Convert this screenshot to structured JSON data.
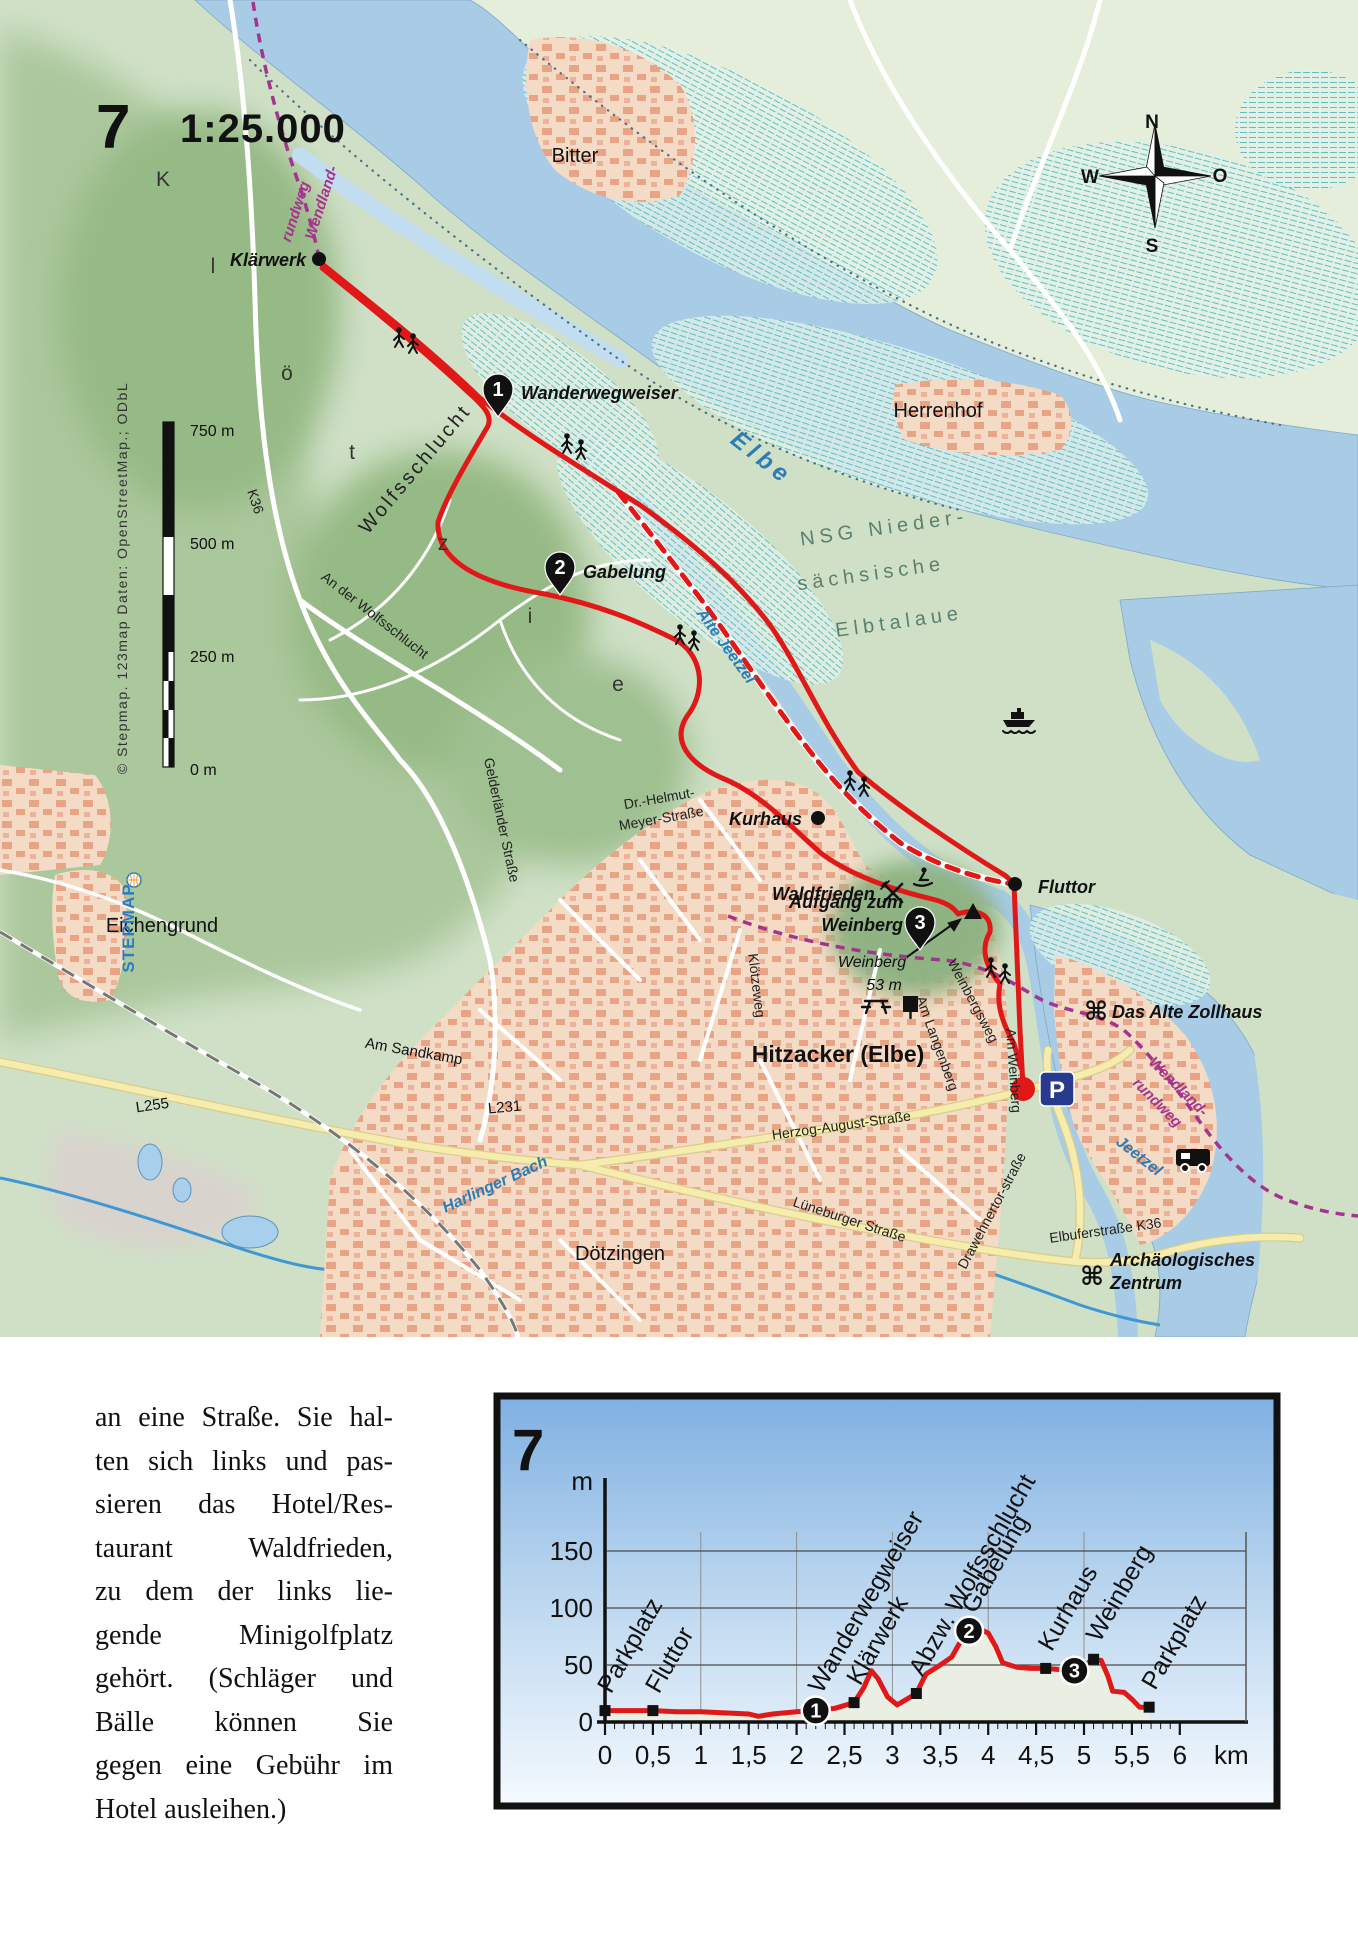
{
  "map": {
    "number": "7",
    "scale": "1:25.000",
    "colors": {
      "base_green": "#cfe0c6",
      "pale_marsh": "#e4eeda",
      "forest": "#9cbd8c",
      "water": "#a8cbe6",
      "water_light": "#c2dcf0",
      "urban": "#f4dbc6",
      "building": "#e9a486",
      "route_red": "#e01818",
      "wendland_purple": "#a5348e",
      "road_yellow": "#f5ecae",
      "rail_gray": "#777777",
      "hatch_teal": "#5fc0bd",
      "parking_blue": "#283a8e"
    },
    "labels": [
      {
        "n": "map-number",
        "t": "7",
        "x": 96,
        "y": 148,
        "c": "t7",
        "a": "start"
      },
      {
        "n": "map-scale-ratio",
        "t": "1:25.000",
        "x": 180,
        "y": 142,
        "c": "tscale",
        "a": "start"
      },
      {
        "n": "label-klaerwerk",
        "t": "Klärwerk",
        "x": 306,
        "y": 266,
        "c": "poi",
        "a": "end"
      },
      {
        "n": "label-bitter",
        "t": "Bitter",
        "x": 575,
        "y": 162,
        "c": "plc"
      },
      {
        "n": "label-herrenhof",
        "t": "Herrenhof",
        "x": 938,
        "y": 417,
        "c": "plc"
      },
      {
        "n": "label-wanderwegweiser",
        "t": "Wanderwegweiser",
        "x": 521,
        "y": 399,
        "c": "poi",
        "a": "start"
      },
      {
        "n": "label-gabelung",
        "t": "Gabelung",
        "x": 583,
        "y": 578,
        "c": "poi",
        "a": "start"
      },
      {
        "n": "label-wolfsschlucht",
        "t": "Wolfsschlucht",
        "x": 420,
        "y": 473,
        "r": -50,
        "c": "area"
      },
      {
        "n": "label-kloetzie-k",
        "t": "K",
        "x": 163,
        "y": 186,
        "c": "arealet"
      },
      {
        "n": "label-kloetzie-l",
        "t": "l",
        "x": 213,
        "y": 273,
        "c": "arealet"
      },
      {
        "n": "label-kloetzie-oe",
        "t": "ö",
        "x": 287,
        "y": 380,
        "c": "arealet"
      },
      {
        "n": "label-kloetzie-t",
        "t": "t",
        "x": 352,
        "y": 459,
        "c": "arealet"
      },
      {
        "n": "label-kloetzie-z",
        "t": "z",
        "x": 443,
        "y": 550,
        "c": "arealet"
      },
      {
        "n": "label-kloetzie-i",
        "t": "i",
        "x": 530,
        "y": 623,
        "c": "arealet"
      },
      {
        "n": "label-kloetzie-e",
        "t": "e",
        "x": 618,
        "y": 691,
        "c": "arealet"
      },
      {
        "n": "label-elbe",
        "t": "Elbe",
        "x": 757,
        "y": 464,
        "r": 38,
        "c": "water-lg"
      },
      {
        "n": "label-nsg-1",
        "t": "NSG Nieder-",
        "x": 885,
        "y": 534,
        "r": -8,
        "c": "nsg"
      },
      {
        "n": "label-nsg-2",
        "t": "sächsische",
        "x": 872,
        "y": 580,
        "r": -8,
        "c": "nsg"
      },
      {
        "n": "label-nsg-3",
        "t": "Elbtalaue",
        "x": 900,
        "y": 628,
        "r": -8,
        "c": "nsg"
      },
      {
        "n": "label-alte-jeetzel",
        "t": "Alte Jeetzel",
        "x": 722,
        "y": 649,
        "r": 54,
        "c": "water"
      },
      {
        "n": "label-kurhaus",
        "t": "Kurhaus",
        "x": 802,
        "y": 825,
        "c": "poi",
        "a": "end"
      },
      {
        "n": "label-fluttor",
        "t": "Fluttor",
        "x": 1038,
        "y": 893,
        "c": "poi",
        "a": "start"
      },
      {
        "n": "label-waldfrieden",
        "t": "Waldfrieden",
        "x": 772,
        "y": 900,
        "c": "poi",
        "a": "start"
      },
      {
        "n": "label-aufgang-zum",
        "t": "Aufgang zum",
        "x": 903,
        "y": 908,
        "c": "poi",
        "a": "end"
      },
      {
        "n": "label-aufgang-weinberg",
        "t": "Weinberg",
        "x": 903,
        "y": 931,
        "c": "poi",
        "a": "end"
      },
      {
        "n": "label-weinberg",
        "t": "Weinberg",
        "x": 872,
        "y": 967,
        "c": "plc-it"
      },
      {
        "n": "label-weinberg-hoehe",
        "t": "53 m",
        "x": 884,
        "y": 990,
        "c": "plc-it"
      },
      {
        "n": "label-hitzacker",
        "t": "Hitzacker (Elbe)",
        "x": 838,
        "y": 1062,
        "c": "city"
      },
      {
        "n": "street-kloetzeweg",
        "t": "Klötzeweg",
        "x": 752,
        "y": 986,
        "r": 83,
        "c": "street"
      },
      {
        "n": "street-am-langenberg",
        "t": "Am Langenberg",
        "x": 933,
        "y": 1045,
        "r": 70,
        "c": "street"
      },
      {
        "n": "street-weinbergsweg",
        "t": "Weinbergsweg",
        "x": 969,
        "y": 1003,
        "r": 62,
        "c": "street"
      },
      {
        "n": "street-am-weinberg",
        "t": "Am Weinberg",
        "x": 1009,
        "y": 1071,
        "r": 86,
        "c": "street"
      },
      {
        "n": "street-drawehnertor",
        "t": "Drawehnertor-straße",
        "x": 996,
        "y": 1213,
        "r": -62,
        "c": "street"
      },
      {
        "n": "street-herzog-august",
        "t": "Herzog-August-Straße",
        "x": 842,
        "y": 1130,
        "r": -8,
        "c": "street"
      },
      {
        "n": "street-lueneburger",
        "t": "Lüneburger Straße",
        "x": 848,
        "y": 1224,
        "r": 18,
        "c": "street"
      },
      {
        "n": "street-gelderlaender",
        "t": "Gelderländer Straße",
        "x": 497,
        "y": 821,
        "r": 78,
        "c": "street"
      },
      {
        "n": "street-an-der-wolfsschlucht",
        "t": "An der Wolfsschlucht",
        "x": 372,
        "y": 619,
        "r": 38,
        "c": "street"
      },
      {
        "n": "street-k36",
        "t": "K36",
        "x": 251,
        "y": 503,
        "r": 72,
        "c": "street"
      },
      {
        "n": "street-elbuferstrasse",
        "t": "Elbuferstraße K36",
        "x": 1106,
        "y": 1235,
        "r": -8,
        "c": "street"
      },
      {
        "n": "street-dr-helmut-1",
        "t": "Dr.-Helmut-",
        "x": 660,
        "y": 803,
        "r": -10,
        "c": "street"
      },
      {
        "n": "street-dr-helmut-2",
        "t": "Meyer-Straße",
        "x": 662,
        "y": 823,
        "r": -10,
        "c": "street"
      },
      {
        "n": "label-zollhaus",
        "t": "Das Alte Zollhaus",
        "x": 1112,
        "y": 1018,
        "c": "poi",
        "a": "start"
      },
      {
        "n": "label-archaeologisches",
        "t": "Archäologisches",
        "x": 1110,
        "y": 1266,
        "c": "poi",
        "a": "start"
      },
      {
        "n": "label-zentrum",
        "t": "Zentrum",
        "x": 1110,
        "y": 1289,
        "c": "poi",
        "a": "start"
      },
      {
        "n": "label-wendland-nw-1",
        "t": "Wendland-",
        "x": 326,
        "y": 204,
        "r": -72,
        "c": "wend"
      },
      {
        "n": "label-wendland-nw-2",
        "t": "rundweg",
        "x": 300,
        "y": 213,
        "r": -72,
        "c": "wend"
      },
      {
        "n": "label-wendland-se-1",
        "t": "Wendland-",
        "x": 1175,
        "y": 1090,
        "r": 45,
        "c": "wend"
      },
      {
        "n": "label-wendland-se-2",
        "t": "rundweg",
        "x": 1154,
        "y": 1106,
        "r": 45,
        "c": "wend"
      },
      {
        "n": "label-eichengrund",
        "t": "Eichengrund",
        "x": 162,
        "y": 932,
        "c": "plc"
      },
      {
        "n": "label-am-sandkamp",
        "t": "Am Sandkamp",
        "x": 413,
        "y": 1056,
        "r": 10,
        "c": "plc-sm"
      },
      {
        "n": "label-l255",
        "t": "L255",
        "x": 153,
        "y": 1110,
        "r": -8,
        "c": "plc-sm"
      },
      {
        "n": "label-l231",
        "t": "L231",
        "x": 505,
        "y": 1112,
        "r": -5,
        "c": "plc-sm"
      },
      {
        "n": "label-harlinger-bach",
        "t": "Harlinger Bach",
        "x": 497,
        "y": 1189,
        "r": -25,
        "c": "water"
      },
      {
        "n": "label-doetzingen",
        "t": "Dötzingen",
        "x": 620,
        "y": 1260,
        "c": "plc"
      },
      {
        "n": "label-jeetzel",
        "t": "Jeetzel",
        "x": 1136,
        "y": 1160,
        "r": 38,
        "c": "water"
      },
      {
        "n": "compass-n",
        "t": "N",
        "x": 1152,
        "y": 128,
        "c": "comp"
      },
      {
        "n": "compass-o",
        "t": "O",
        "x": 1220,
        "y": 182,
        "c": "comp"
      },
      {
        "n": "compass-s",
        "t": "S",
        "x": 1152,
        "y": 252,
        "c": "comp"
      },
      {
        "n": "compass-w",
        "t": "W",
        "x": 1090,
        "y": 183,
        "c": "comp"
      },
      {
        "n": "scalebar-750",
        "t": "750 m",
        "x": 190,
        "y": 436,
        "c": "sb",
        "a": "start"
      },
      {
        "n": "scalebar-500",
        "t": "500 m",
        "x": 190,
        "y": 549,
        "c": "sb",
        "a": "start"
      },
      {
        "n": "scalebar-250",
        "t": "250 m",
        "x": 190,
        "y": 662,
        "c": "sb",
        "a": "start"
      },
      {
        "n": "scalebar-0",
        "t": "0 m",
        "x": 190,
        "y": 775,
        "c": "sb",
        "a": "start"
      },
      {
        "n": "attribution-credit",
        "t": "© Stepmap. 123map Daten: OpenStreetMap.; ODbL",
        "x": 127,
        "y": 578,
        "r": -90,
        "c": "attr"
      },
      {
        "n": "attribution-brand",
        "t": "STEPMAP",
        "x": 134,
        "y": 928,
        "r": -90,
        "c": "attr-brand"
      }
    ],
    "markers": [
      {
        "num": "1",
        "x": 498,
        "y": 417
      },
      {
        "num": "2",
        "x": 560,
        "y": 595
      },
      {
        "num": "3",
        "x": 920,
        "y": 950
      }
    ],
    "dots": [
      {
        "n": "dot-klaerwerk",
        "x": 319,
        "y": 259,
        "r": 7
      },
      {
        "n": "dot-kurhaus",
        "x": 818,
        "y": 818,
        "r": 7
      },
      {
        "n": "dot-fluttor",
        "x": 1015,
        "y": 884,
        "r": 7
      }
    ],
    "start_dot": {
      "x": 1023,
      "y": 1089,
      "r": 12
    },
    "parking": {
      "t": "P",
      "x": 1040,
      "y": 1072
    },
    "icons": [
      {
        "t": "hikers",
        "x": 405,
        "y": 338
      },
      {
        "t": "hikers",
        "x": 573,
        "y": 444
      },
      {
        "t": "hikers",
        "x": 686,
        "y": 635
      },
      {
        "t": "hikers",
        "x": 856,
        "y": 781
      },
      {
        "t": "hikers",
        "x": 997,
        "y": 968
      },
      {
        "t": "ferry",
        "x": 1019,
        "y": 716
      },
      {
        "t": "camper",
        "x": 1193,
        "y": 1158
      },
      {
        "t": "picnic",
        "x": 876,
        "y": 1005
      },
      {
        "t": "info",
        "x": 903,
        "y": 1004
      },
      {
        "t": "restaurant",
        "x": 893,
        "y": 893
      },
      {
        "t": "sled",
        "x": 922,
        "y": 878
      },
      {
        "t": "viewpoint",
        "x": 973,
        "y": 913
      },
      {
        "t": "poi-sign",
        "x": 1096,
        "y": 1012
      },
      {
        "t": "poi-sign",
        "x": 1092,
        "y": 1277
      },
      {
        "t": "globe",
        "x": 134,
        "y": 880
      }
    ]
  },
  "article": {
    "lines": [
      "an eine Straße. Sie hal-",
      "ten sich links und pas-",
      "sieren das Hotel/Res-",
      "taurant  Waldfrieden,",
      "zu dem der links lie-",
      "gende  Minigolfplatz",
      "gehört. (Schläger und",
      "Bälle  können  Sie",
      "gegen eine Gebühr im",
      "Hotel ausleihen.)"
    ]
  },
  "chart_data": {
    "type": "area",
    "number": "7",
    "ylabel": "m",
    "xlabel": "km",
    "ylim": [
      0,
      175
    ],
    "xlim": [
      0,
      6
    ],
    "yticks": [
      0,
      50,
      100,
      150
    ],
    "xticks": [
      0,
      0.5,
      1,
      1.5,
      2,
      2.5,
      3,
      3.5,
      4,
      4.5,
      5,
      5.5,
      6
    ],
    "xtick_labels": [
      "0",
      "0,5",
      "1",
      "1,5",
      "2",
      "2,5",
      "3",
      "3,5",
      "4",
      "4,5",
      "5",
      "5,5",
      "6"
    ],
    "grid": true,
    "line_color": "#e01818",
    "fill_color": "#e9efe3",
    "profile": [
      [
        0,
        10
      ],
      [
        0.25,
        10
      ],
      [
        0.5,
        10
      ],
      [
        0.75,
        9
      ],
      [
        1,
        9
      ],
      [
        1.25,
        8
      ],
      [
        1.5,
        7
      ],
      [
        1.6,
        5
      ],
      [
        1.75,
        7
      ],
      [
        2,
        9
      ],
      [
        2.2,
        10
      ],
      [
        2.4,
        12
      ],
      [
        2.6,
        17
      ],
      [
        2.7,
        30
      ],
      [
        2.78,
        45
      ],
      [
        2.85,
        38
      ],
      [
        2.95,
        22
      ],
      [
        3.05,
        15
      ],
      [
        3.15,
        20
      ],
      [
        3.25,
        25
      ],
      [
        3.35,
        42
      ],
      [
        3.5,
        50
      ],
      [
        3.62,
        57
      ],
      [
        3.72,
        72
      ],
      [
        3.8,
        80
      ],
      [
        3.9,
        82
      ],
      [
        4,
        78
      ],
      [
        4.08,
        66
      ],
      [
        4.15,
        52
      ],
      [
        4.3,
        48
      ],
      [
        4.45,
        47
      ],
      [
        4.6,
        47
      ],
      [
        4.75,
        46
      ],
      [
        4.9,
        45
      ],
      [
        5,
        48
      ],
      [
        5.08,
        55
      ],
      [
        5.18,
        54
      ],
      [
        5.25,
        40
      ],
      [
        5.3,
        27
      ],
      [
        5.42,
        26
      ],
      [
        5.5,
        20
      ],
      [
        5.58,
        13
      ],
      [
        5.68,
        13
      ]
    ],
    "waypoints": [
      {
        "label": "Parkplatz",
        "km": 0,
        "elev": 10
      },
      {
        "label": "Fluttor",
        "km": 0.5,
        "elev": 10
      },
      {
        "label": "Wanderwegweiser",
        "km": 2.2,
        "elev": 10,
        "num": "1"
      },
      {
        "label": "Klärwerk",
        "km": 2.6,
        "elev": 17
      },
      {
        "label": "Abzw. Wolfsschlucht",
        "km": 3.25,
        "elev": 25
      },
      {
        "label": "Gabelung",
        "km": 3.8,
        "elev": 80,
        "num": "2"
      },
      {
        "label": "Kurhaus",
        "km": 4.6,
        "elev": 47
      },
      {
        "label": "",
        "km": 4.9,
        "elev": 45,
        "num": "3"
      },
      {
        "label": "Weinberg",
        "km": 5.1,
        "elev": 55
      },
      {
        "label": "Parkplatz",
        "km": 5.68,
        "elev": 13
      }
    ]
  }
}
